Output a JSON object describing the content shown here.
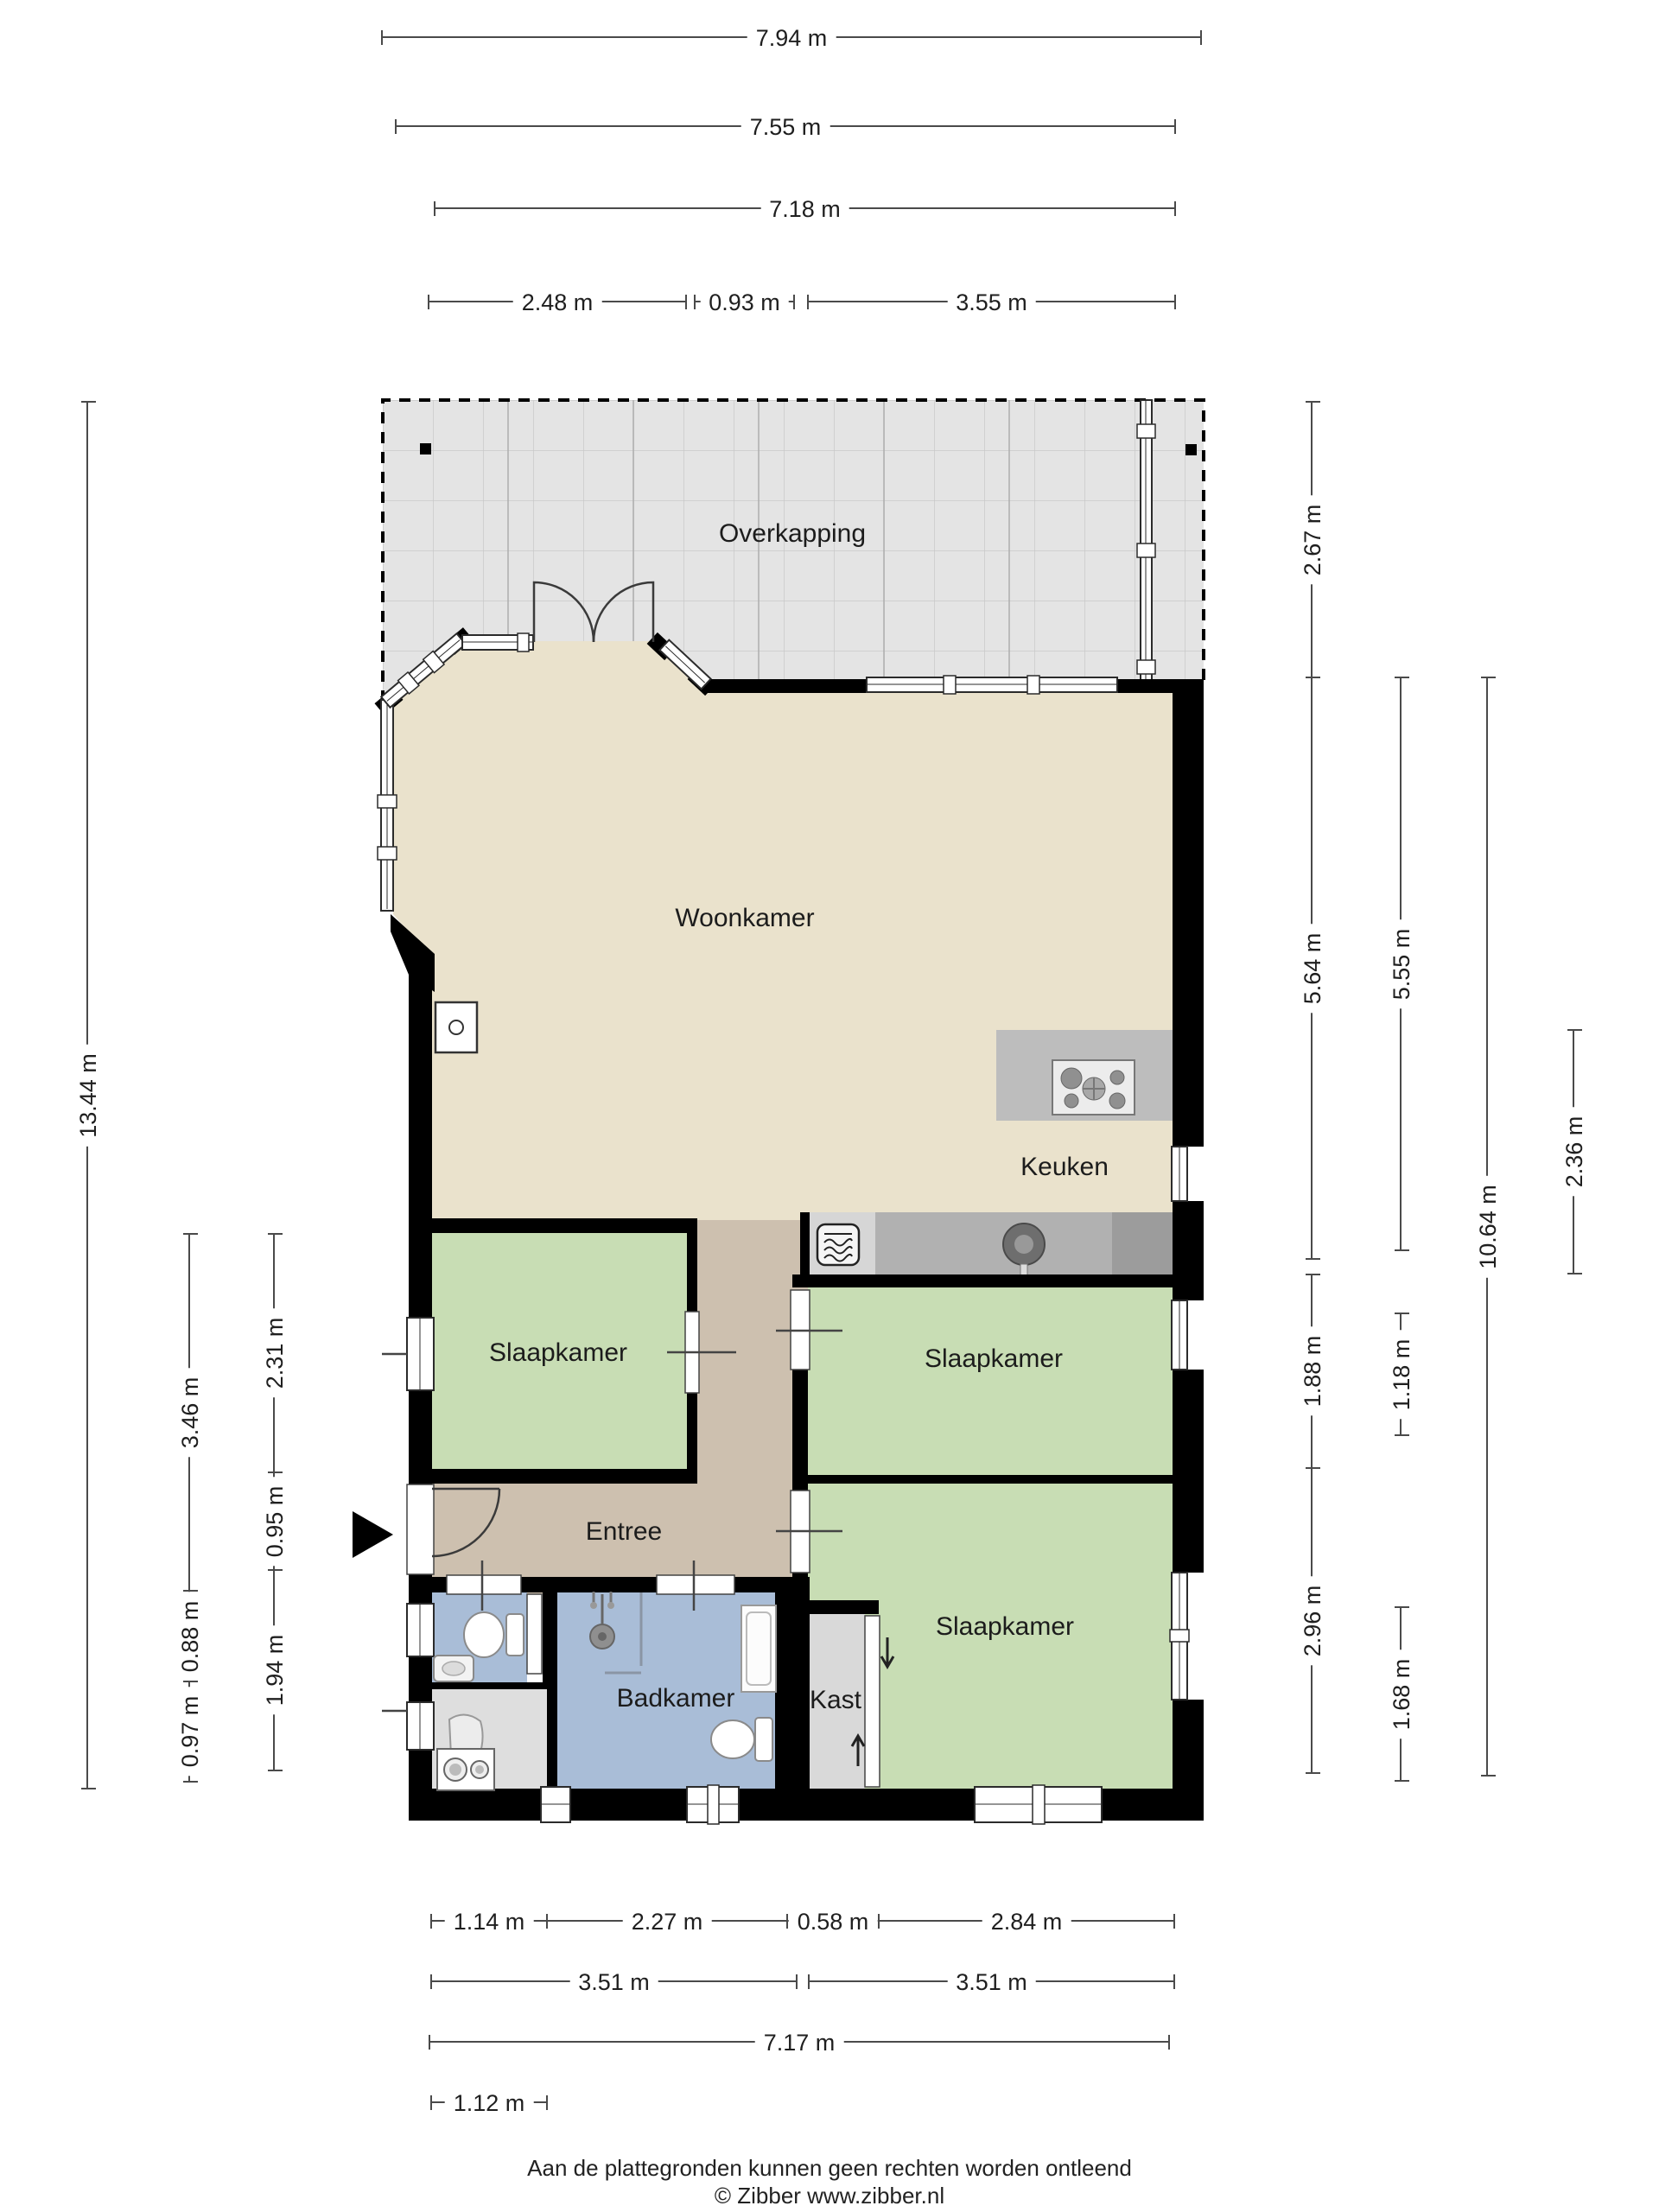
{
  "rooms": {
    "overkapping": "Overkapping",
    "woonkamer": "Woonkamer",
    "keuken": "Keuken",
    "slaapkamer_left": "Slaapkamer",
    "slaapkamer_mid": "Slaapkamer",
    "slaapkamer_bottom": "Slaapkamer",
    "entree": "Entree",
    "badkamer": "Badkamer",
    "kast": "Kast"
  },
  "dimensions": {
    "top": [
      "7.94 m",
      "7.55 m",
      "7.18 m",
      "2.48 m",
      "0.93 m",
      "3.55 m"
    ],
    "bottom": [
      "1.14 m",
      "2.27 m",
      "0.58 m",
      "2.84 m",
      "3.51 m",
      "3.51 m",
      "7.17 m",
      "1.12 m"
    ],
    "left": [
      "13.44 m",
      "3.46 m",
      "0.88 m",
      "0.97 m",
      "2.31 m",
      "0.95 m",
      "1.94 m"
    ],
    "right": [
      "2.67 m",
      "5.64 m",
      "1.88 m",
      "2.96 m",
      "5.55 m",
      "1.18 m",
      "1.68 m",
      "10.64 m",
      "2.36 m"
    ]
  },
  "footer": {
    "disclaimer": "Aan de plattegronden kunnen geen rechten worden ontleend",
    "copyright": "© Zibber www.zibber.nl"
  },
  "legend_colors": {
    "living_floor": "#eae2cc",
    "hall_floor": "#cdc0af",
    "bedroom_floor": "#c8ddb4",
    "bathroom_floor": "#a9bdd7",
    "storage_floor": "#d9d9d9",
    "canopy_floor": "#e4e4e4",
    "wall": "#000000"
  }
}
